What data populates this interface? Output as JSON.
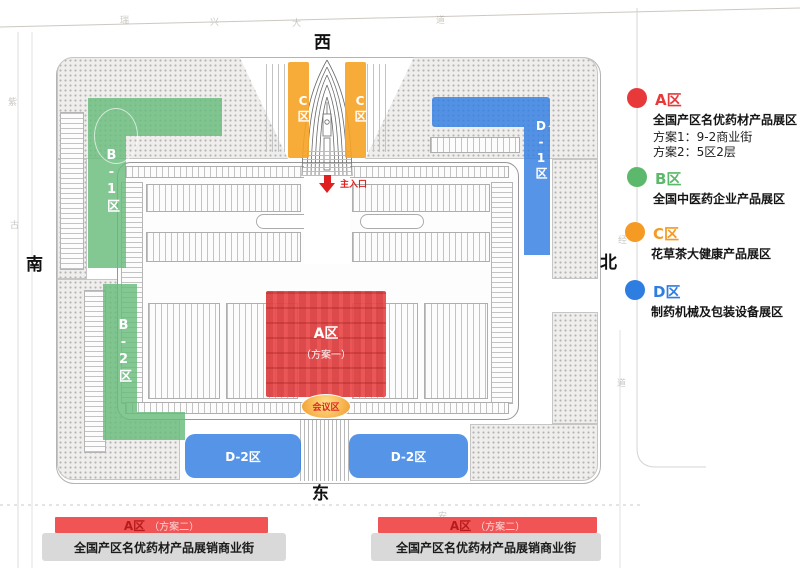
{
  "compass": {
    "west": "西",
    "south": "南",
    "north": "北",
    "east": "东"
  },
  "roads": {
    "top_chars": [
      "瑞",
      "兴",
      "大",
      "道"
    ],
    "left_chars": [
      "紫",
      "古"
    ],
    "right_chars": [
      "经",
      "道"
    ],
    "bottom_char": "安"
  },
  "plan": {
    "entrance": {
      "label": "主入口"
    },
    "zone_a": {
      "title": "A区",
      "scheme": "（方案一）"
    },
    "conference": {
      "label": "会议区"
    },
    "zones": {
      "b1": "B-1区",
      "b2": "B-2区",
      "c_left": "C区",
      "c_right": "C区",
      "d1": "D-1区",
      "d2_left": "D-2区",
      "d2_right": "D-2区"
    }
  },
  "legend": {
    "items": [
      {
        "id": "A",
        "title": "A区",
        "color": "#e8393a",
        "desc": "全国产区名优药材产品展区",
        "lines": [
          "方案1：9-2商业街",
          "方案2：5区2层"
        ]
      },
      {
        "id": "B",
        "title": "B区",
        "color": "#5cb86a",
        "desc": "全国中医药企业产品展区",
        "lines": []
      },
      {
        "id": "C",
        "title": "C区",
        "color": "#f59a23",
        "desc": "花草茶大健康产品展区",
        "lines": []
      },
      {
        "id": "D",
        "title": "D区",
        "color": "#2e7de0",
        "desc": "制药机械及包装设备展区",
        "lines": []
      }
    ]
  },
  "banners": [
    {
      "title": "A区",
      "scheme": "（方案二）",
      "desc": "全国产区名优药材产品展销商业街"
    },
    {
      "title": "A区",
      "scheme": "（方案二）",
      "desc": "全国产区名优药材产品展销商业街"
    }
  ],
  "colors": {
    "zone_a": "#e9494a",
    "zone_b": "#68bc7b",
    "zone_c": "#f6a223",
    "zone_d": "#2f7de0",
    "banner_red": "#f15455",
    "banner_gray": "#d9d9d9",
    "entrance_arrow": "#e02020"
  }
}
